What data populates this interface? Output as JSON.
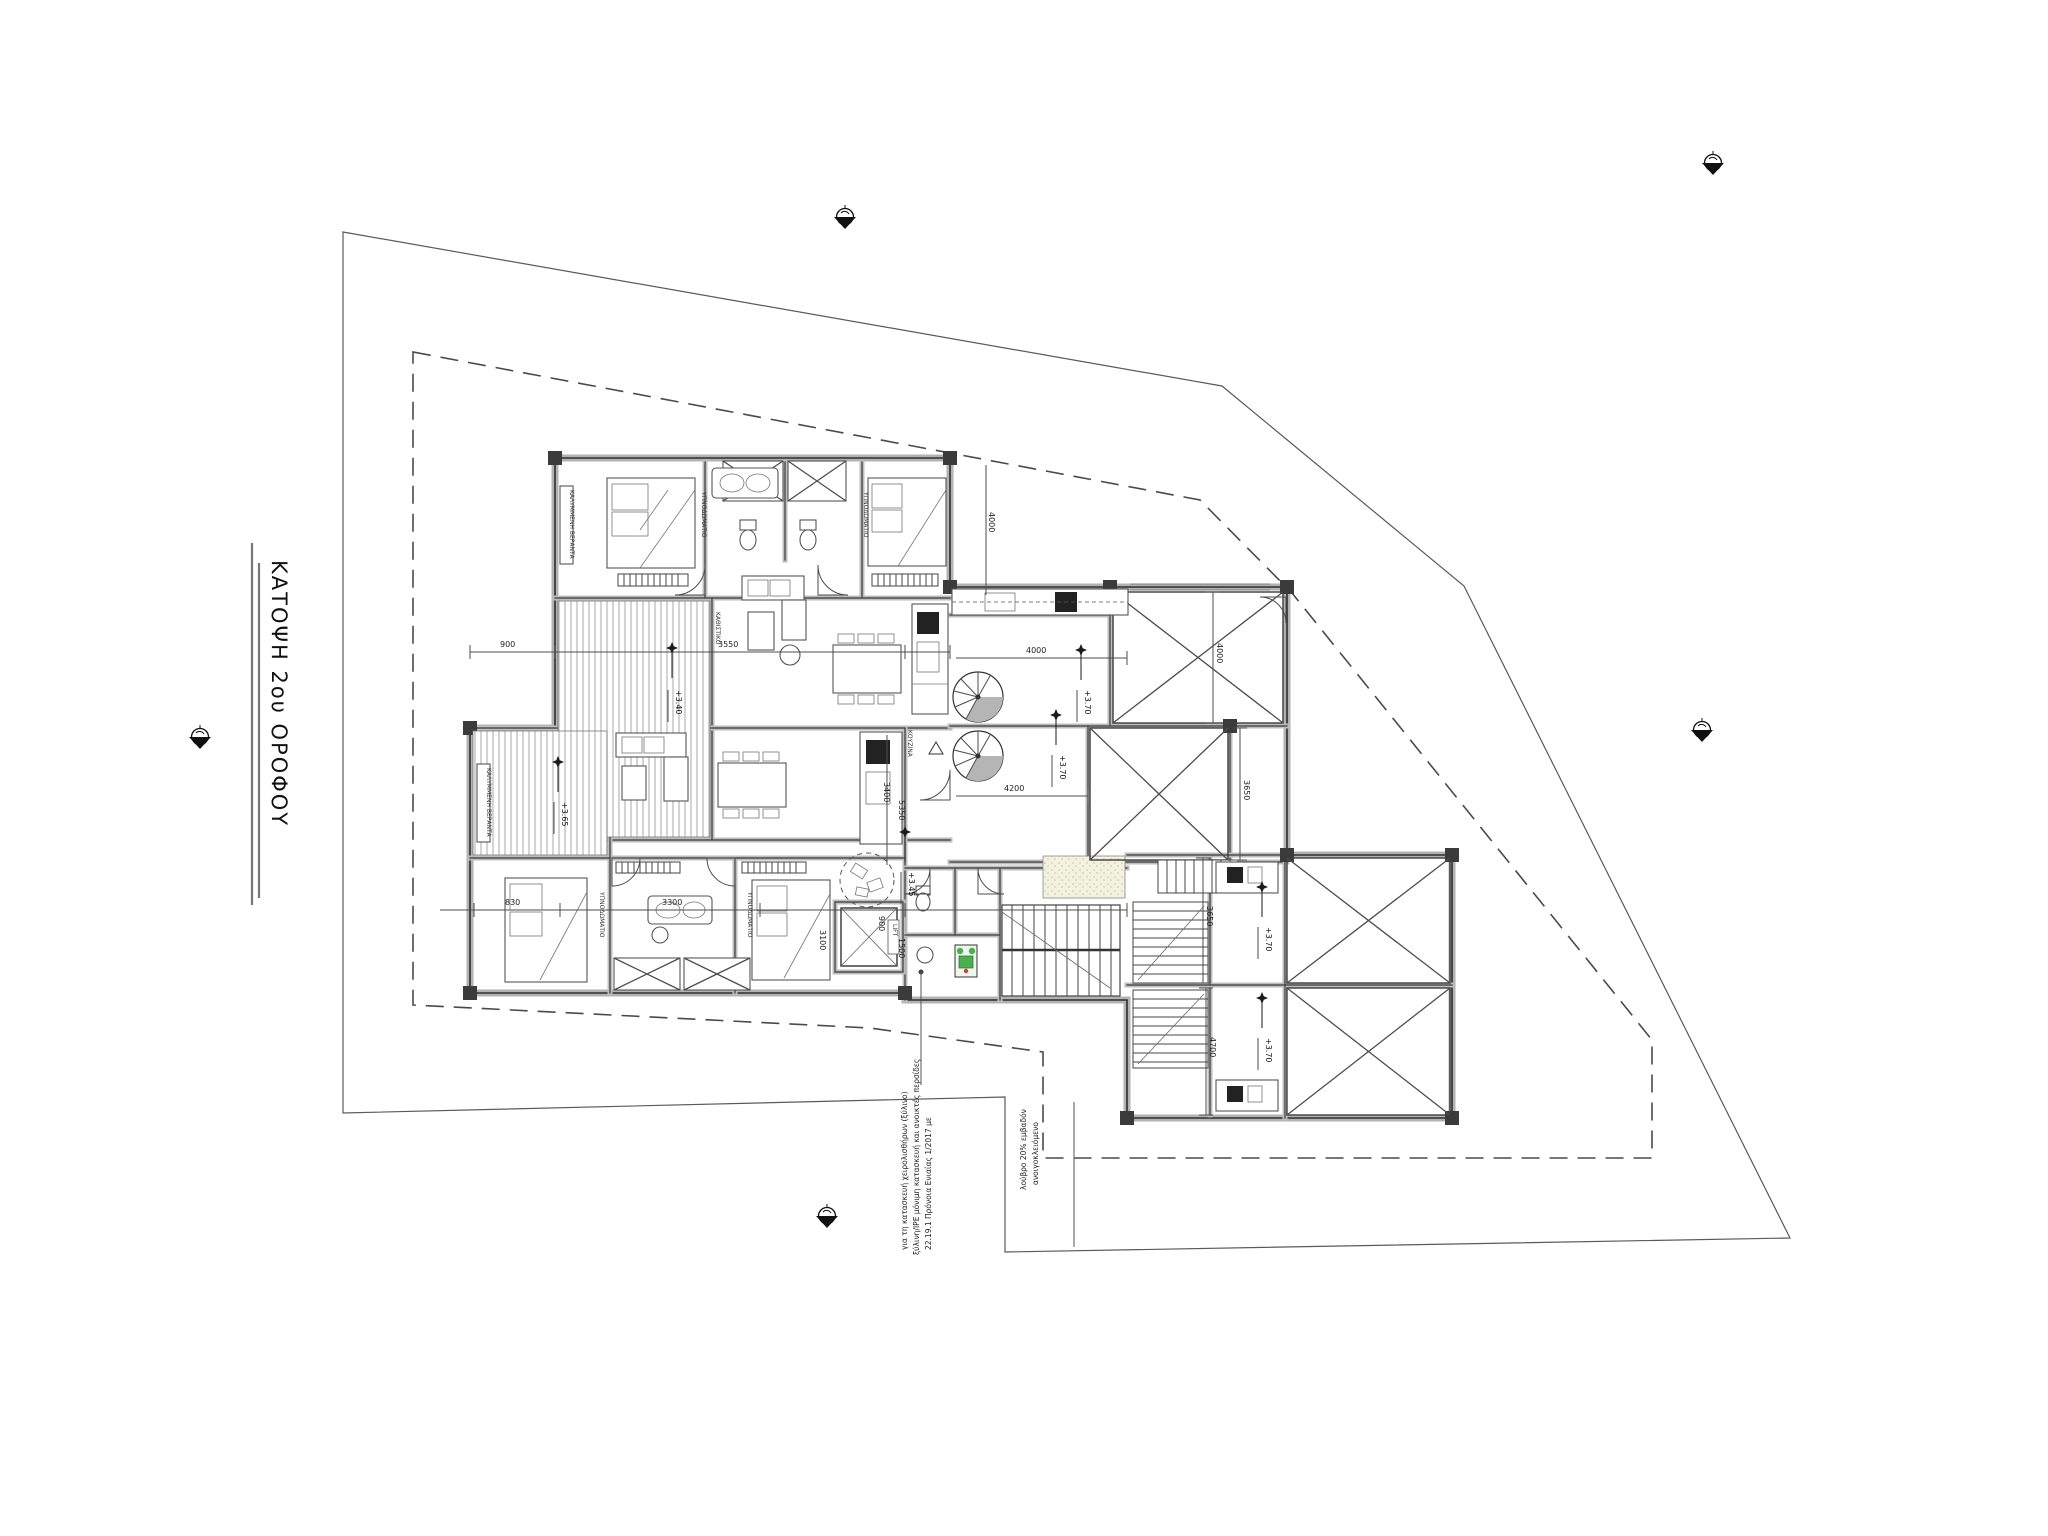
{
  "title": "ΚΑΤΟΨΗ 2ου ΟΡΟΦΟΥ",
  "labels": {
    "lift": "LIFT",
    "balcony_upper": "ΚΑΛΥΜΜΕΝΗ ΒΕΡΑΝΤΑ",
    "balcony_lower": "ΚΑΛΥΜΜΕΝΗ ΒΕΡΑΝΤΑ",
    "bedroom1": "ΥΠΝΟΔΩΜΑΤΙΟ",
    "bedroom2": "ΥΠΝΟΔΩΜΑΤΙΟ",
    "bedroom3": "ΥΠΝΟΔΩΜΑΤΙΟ",
    "bedroom4": "ΥΠΝΟΔΩΜΑΤΙΟ",
    "kitchen": "ΚΟΥΖΙΝΑ",
    "living": "ΚΑΘΙΣΤΙΚΟ"
  },
  "levels": [
    "+3.40",
    "+3.65",
    "+3.45",
    "+3.70",
    "+3.70",
    "+3.70",
    "+3.70"
  ],
  "dimensions": [
    "900",
    "3550",
    "830",
    "3300",
    "3100",
    "3400",
    "5350",
    "900",
    "1500",
    "4000",
    "4200",
    "4000",
    "3650",
    "3650",
    "4700",
    "4000"
  ],
  "annotations": {
    "note1_line1": "22.19.1 Πρόνοια Ενιαίας 1/2017 με",
    "note1_line2": "ξύλινη/ΙΡΕ μόνιμη κατασκευή και ανοικτές περσίδες",
    "note1_line3": "για τη κατασκευή χειρολισθήρων (ξύλινο)",
    "note2_line1": "ανοιγοκλειόμενο",
    "note2_line2": "λούβρο 20% εμβαδόν"
  },
  "colors": {
    "accent_green": "#4caf50",
    "terrace_fill": "#f3f2df"
  }
}
